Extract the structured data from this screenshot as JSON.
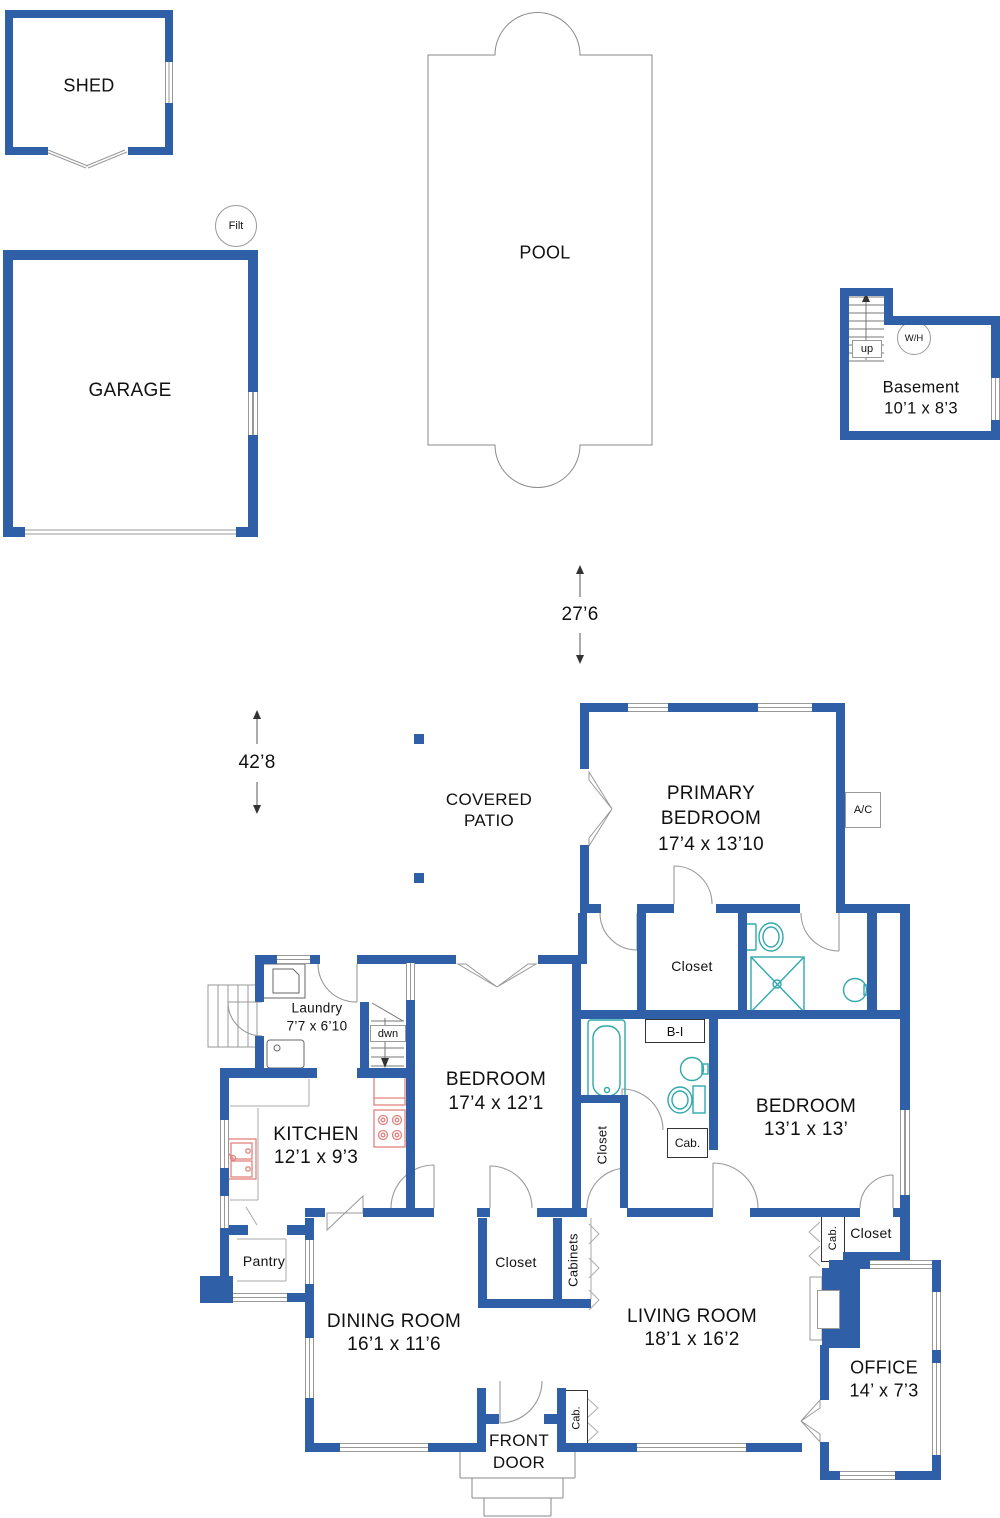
{
  "colors": {
    "wall_blue": "#2e5fa7",
    "fixture_teal": "#2fa8ac",
    "appliance_red": "#e2827e",
    "line_gray": "#999999"
  },
  "shed": {
    "label": "SHED"
  },
  "garage": {
    "label": "GARAGE",
    "filter": "Filt"
  },
  "pool": {
    "label": "POOL"
  },
  "basement": {
    "name": "Basement",
    "dims": "10’1 x 8’3",
    "stairs": "up",
    "water_heater": "W/H"
  },
  "site_dims": {
    "width": "27’6",
    "depth": "42’8"
  },
  "rooms": {
    "patio": {
      "l1": "COVERED",
      "l2": "PATIO"
    },
    "primary": {
      "l1": "PRIMARY",
      "l2": "BEDROOM",
      "d": "17’4 x 13’10"
    },
    "bed_mid": {
      "l1": "BEDROOM",
      "d": "17’4 x 12’1"
    },
    "bed_right": {
      "l1": "BEDROOM",
      "d": "13’1 x 13’"
    },
    "laundry": {
      "l1": "Laundry",
      "d": "7’7 x 6’10"
    },
    "kitchen": {
      "l1": "KITCHEN",
      "d": "12’1 x 9’3"
    },
    "dining": {
      "l1": "DINING ROOM",
      "d": "16’1 x 11’6"
    },
    "living": {
      "l1": "LIVING ROOM",
      "d": "18’1 x 16’2"
    },
    "office": {
      "l1": "OFFICE",
      "d": "14’ x 7’3"
    },
    "pantry": {
      "l1": "Pantry"
    },
    "front": {
      "l1": "FRONT",
      "l2": "DOOR"
    }
  },
  "tags": {
    "closet": "Closet",
    "cab": "Cab.",
    "cabinets": "Cabinets",
    "built_in": "B-I",
    "ac": "A/C",
    "dwn": "dwn"
  }
}
